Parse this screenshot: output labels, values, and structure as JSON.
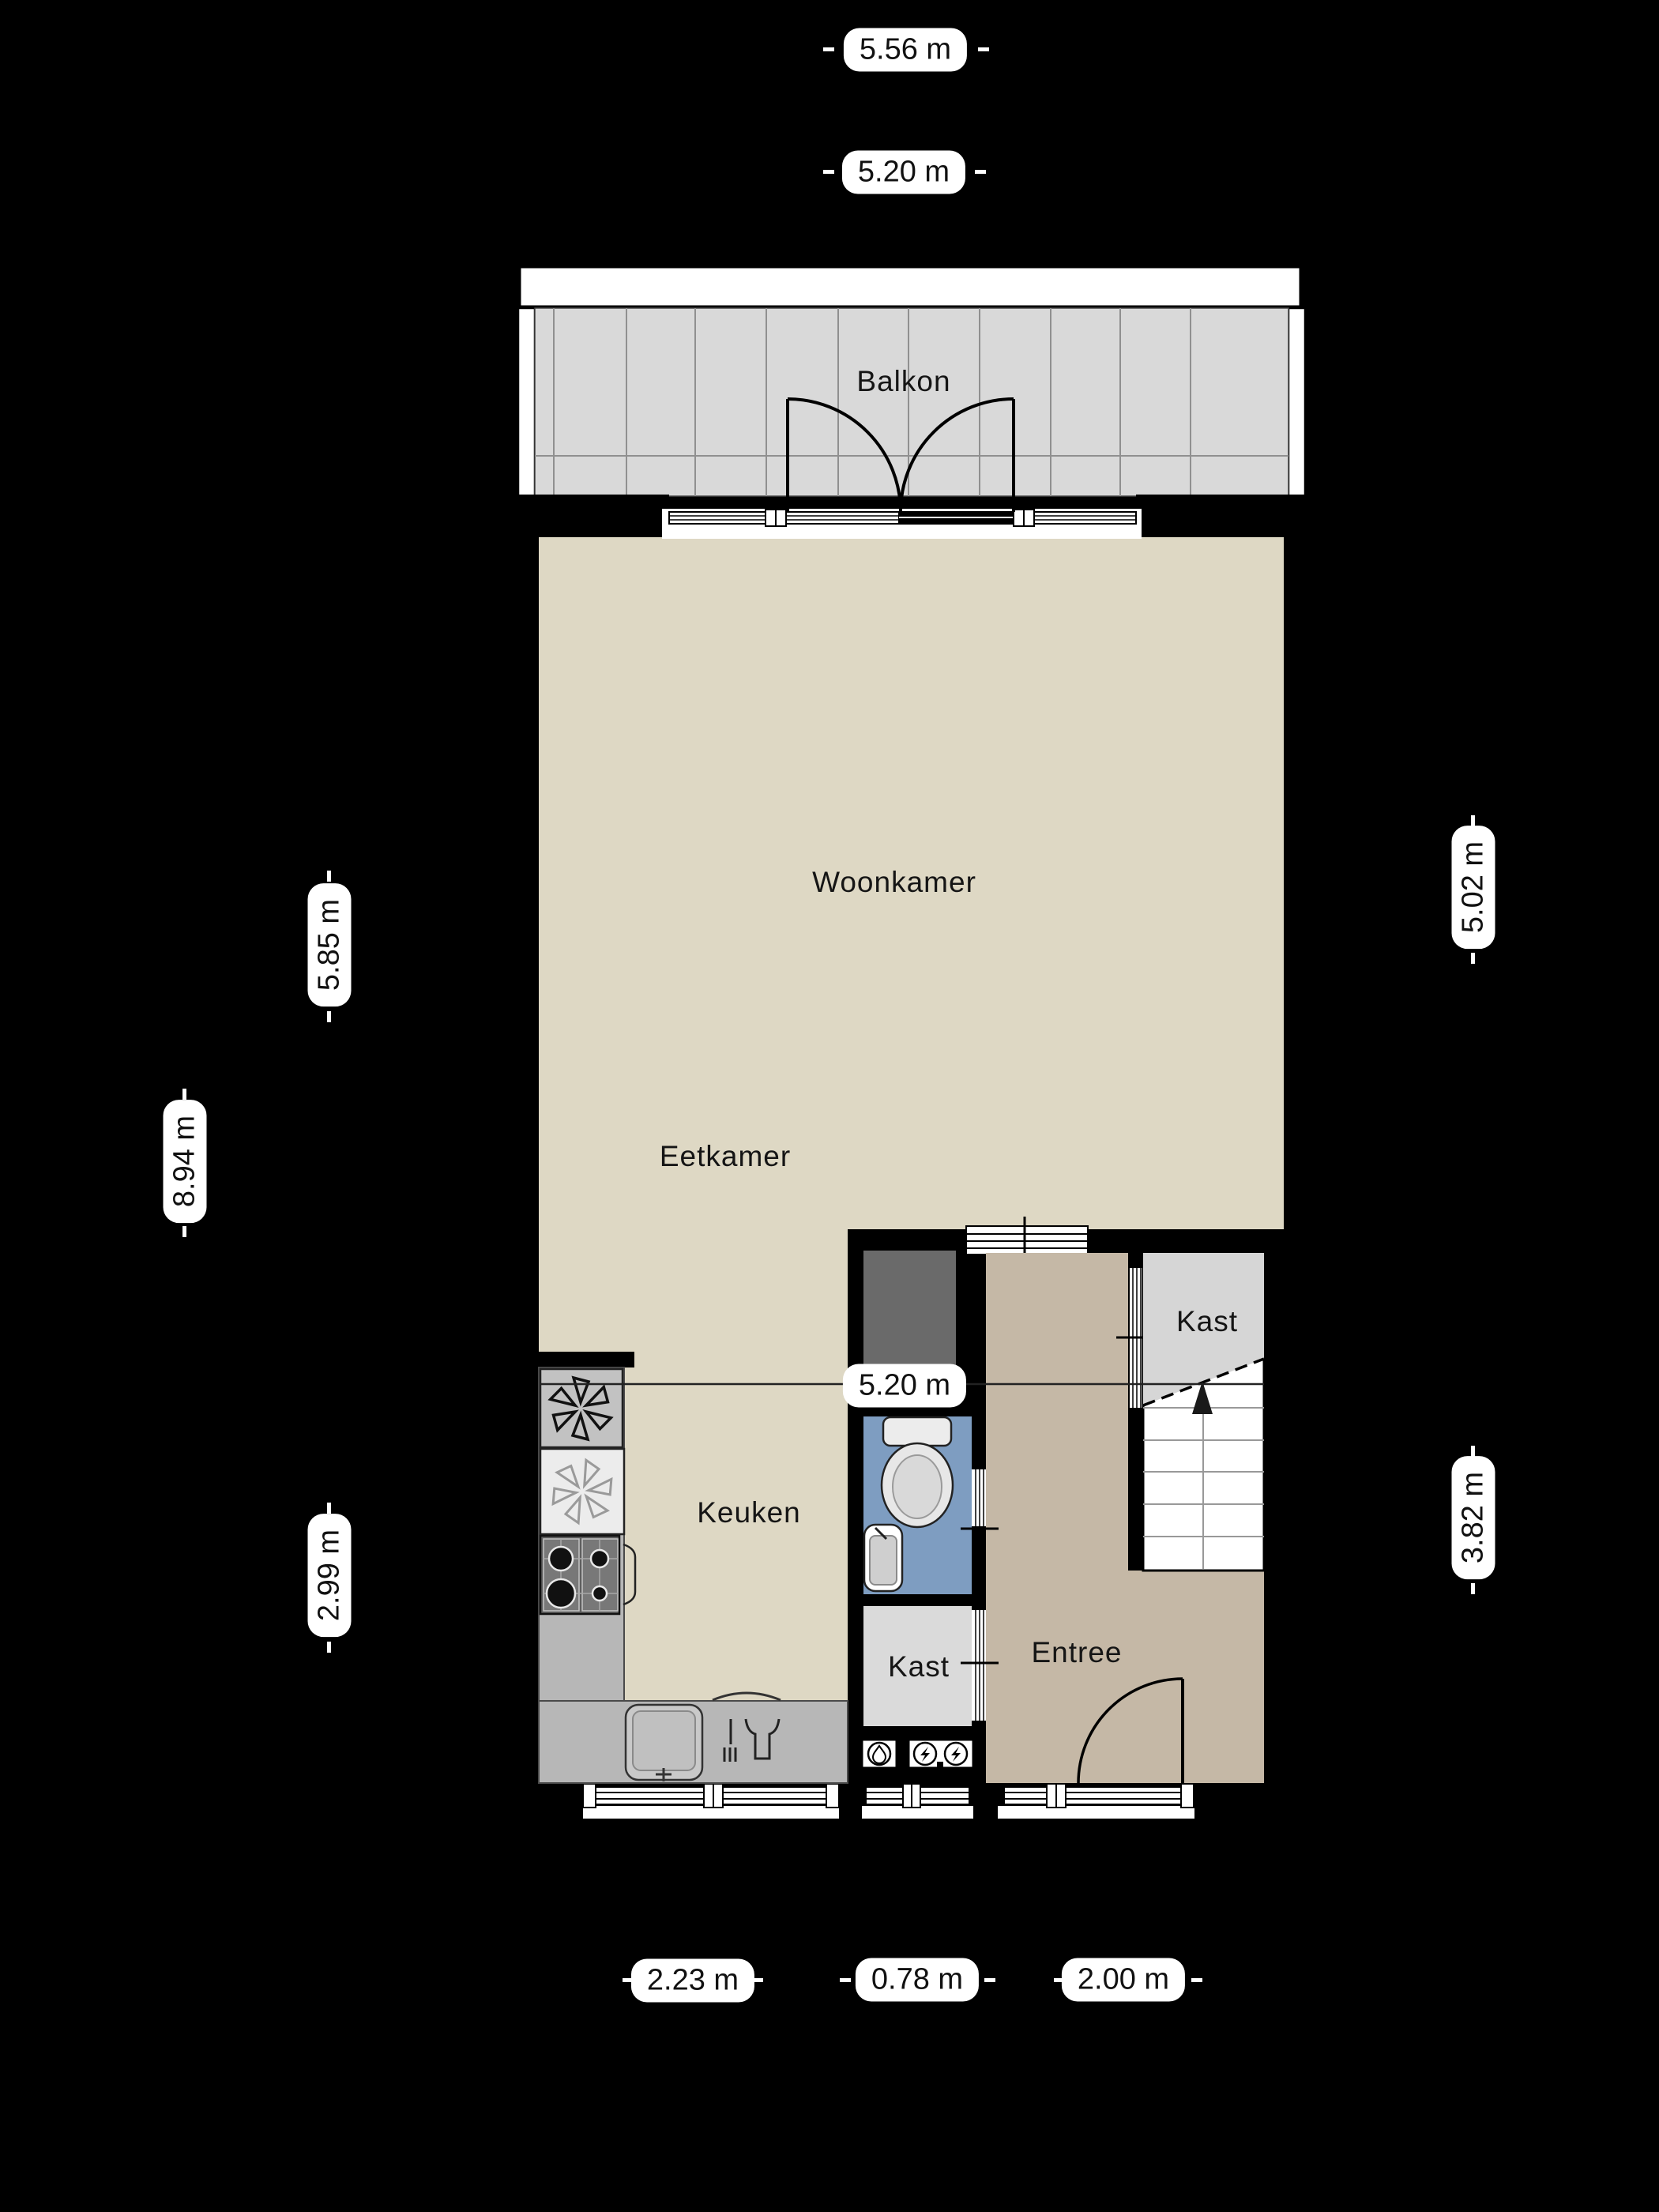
{
  "rooms": {
    "balcony": {
      "label": "Balkon"
    },
    "living": {
      "label": "Woonkamer"
    },
    "dining": {
      "label": "Eetkamer"
    },
    "kitchen": {
      "label": "Keuken"
    },
    "closet_top": {
      "label": "Kast"
    },
    "closet_meter": {
      "label": "Kast"
    },
    "entry": {
      "label": "Entree"
    }
  },
  "dimensions": {
    "top_outer_width": "5.56 m",
    "top_inner_width": "5.20 m",
    "left_living_height": "5.85 m",
    "left_total_height": "8.94 m",
    "right_living_height": "5.02 m",
    "middle_width": "5.20 m",
    "left_kitchen_height": "2.99 m",
    "right_lower_height": "3.82 m",
    "bottom_kitchen": "2.23 m",
    "bottom_bathroom": "0.78 m",
    "bottom_entry": "2.00 m"
  },
  "colors": {
    "bg": "#000000",
    "label-bg": "#ffffff",
    "floor-beige": "#ded8c4",
    "floor-entry": "#c5b8a6",
    "floor-bath": "#7e9dc1",
    "floor-closet-top": "#d6d6d6",
    "floor-closet-meter": "#dadada",
    "floor-balcony": "#d9d9d9",
    "shaft-gray": "#6a6a6a",
    "counter-gray": "#b7b7b7",
    "wall": "#000000",
    "stairs-white": "#ffffff"
  }
}
